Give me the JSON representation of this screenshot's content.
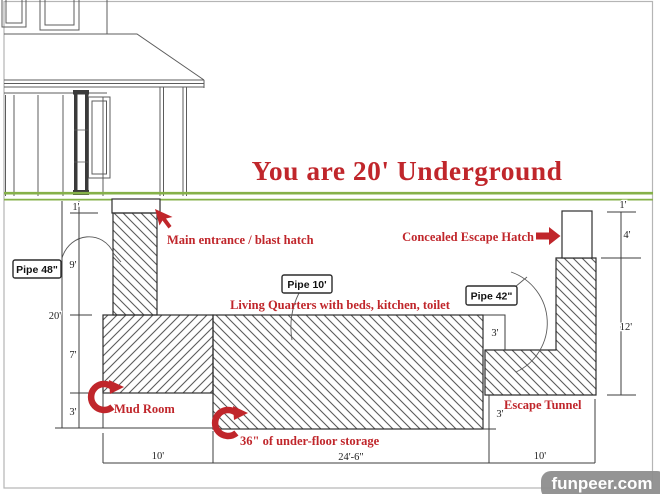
{
  "title": "You are 20' Underground",
  "annotations": {
    "main_entrance": "Main entrance / blast hatch",
    "concealed_hatch": "Concealed Escape Hatch",
    "living_quarters": "Living Quarters with beds, kitchen, toilet",
    "mud_room": "Mud Room",
    "under_floor_storage": "36\" of under-floor storage",
    "escape_tunnel": "Escape Tunnel"
  },
  "pipe_labels": {
    "pipe48": "Pipe 48\"",
    "pipe10": "Pipe 10'",
    "pipe42": "Pipe 42\""
  },
  "dims": {
    "left": [
      "1'",
      "9'",
      "20'",
      "7'",
      "3'"
    ],
    "right": [
      "1'",
      "4'",
      "12'"
    ],
    "steps": [
      "3'",
      "3'"
    ],
    "bottom": [
      "10'",
      "24'-6\"",
      "10'"
    ]
  },
  "watermark": "funpeer.com",
  "colors": {
    "accent_red": "#c0262b",
    "ground_green": "#85b149",
    "line": "#3d3d3d",
    "watermark_bg": "#8e8e8e"
  }
}
